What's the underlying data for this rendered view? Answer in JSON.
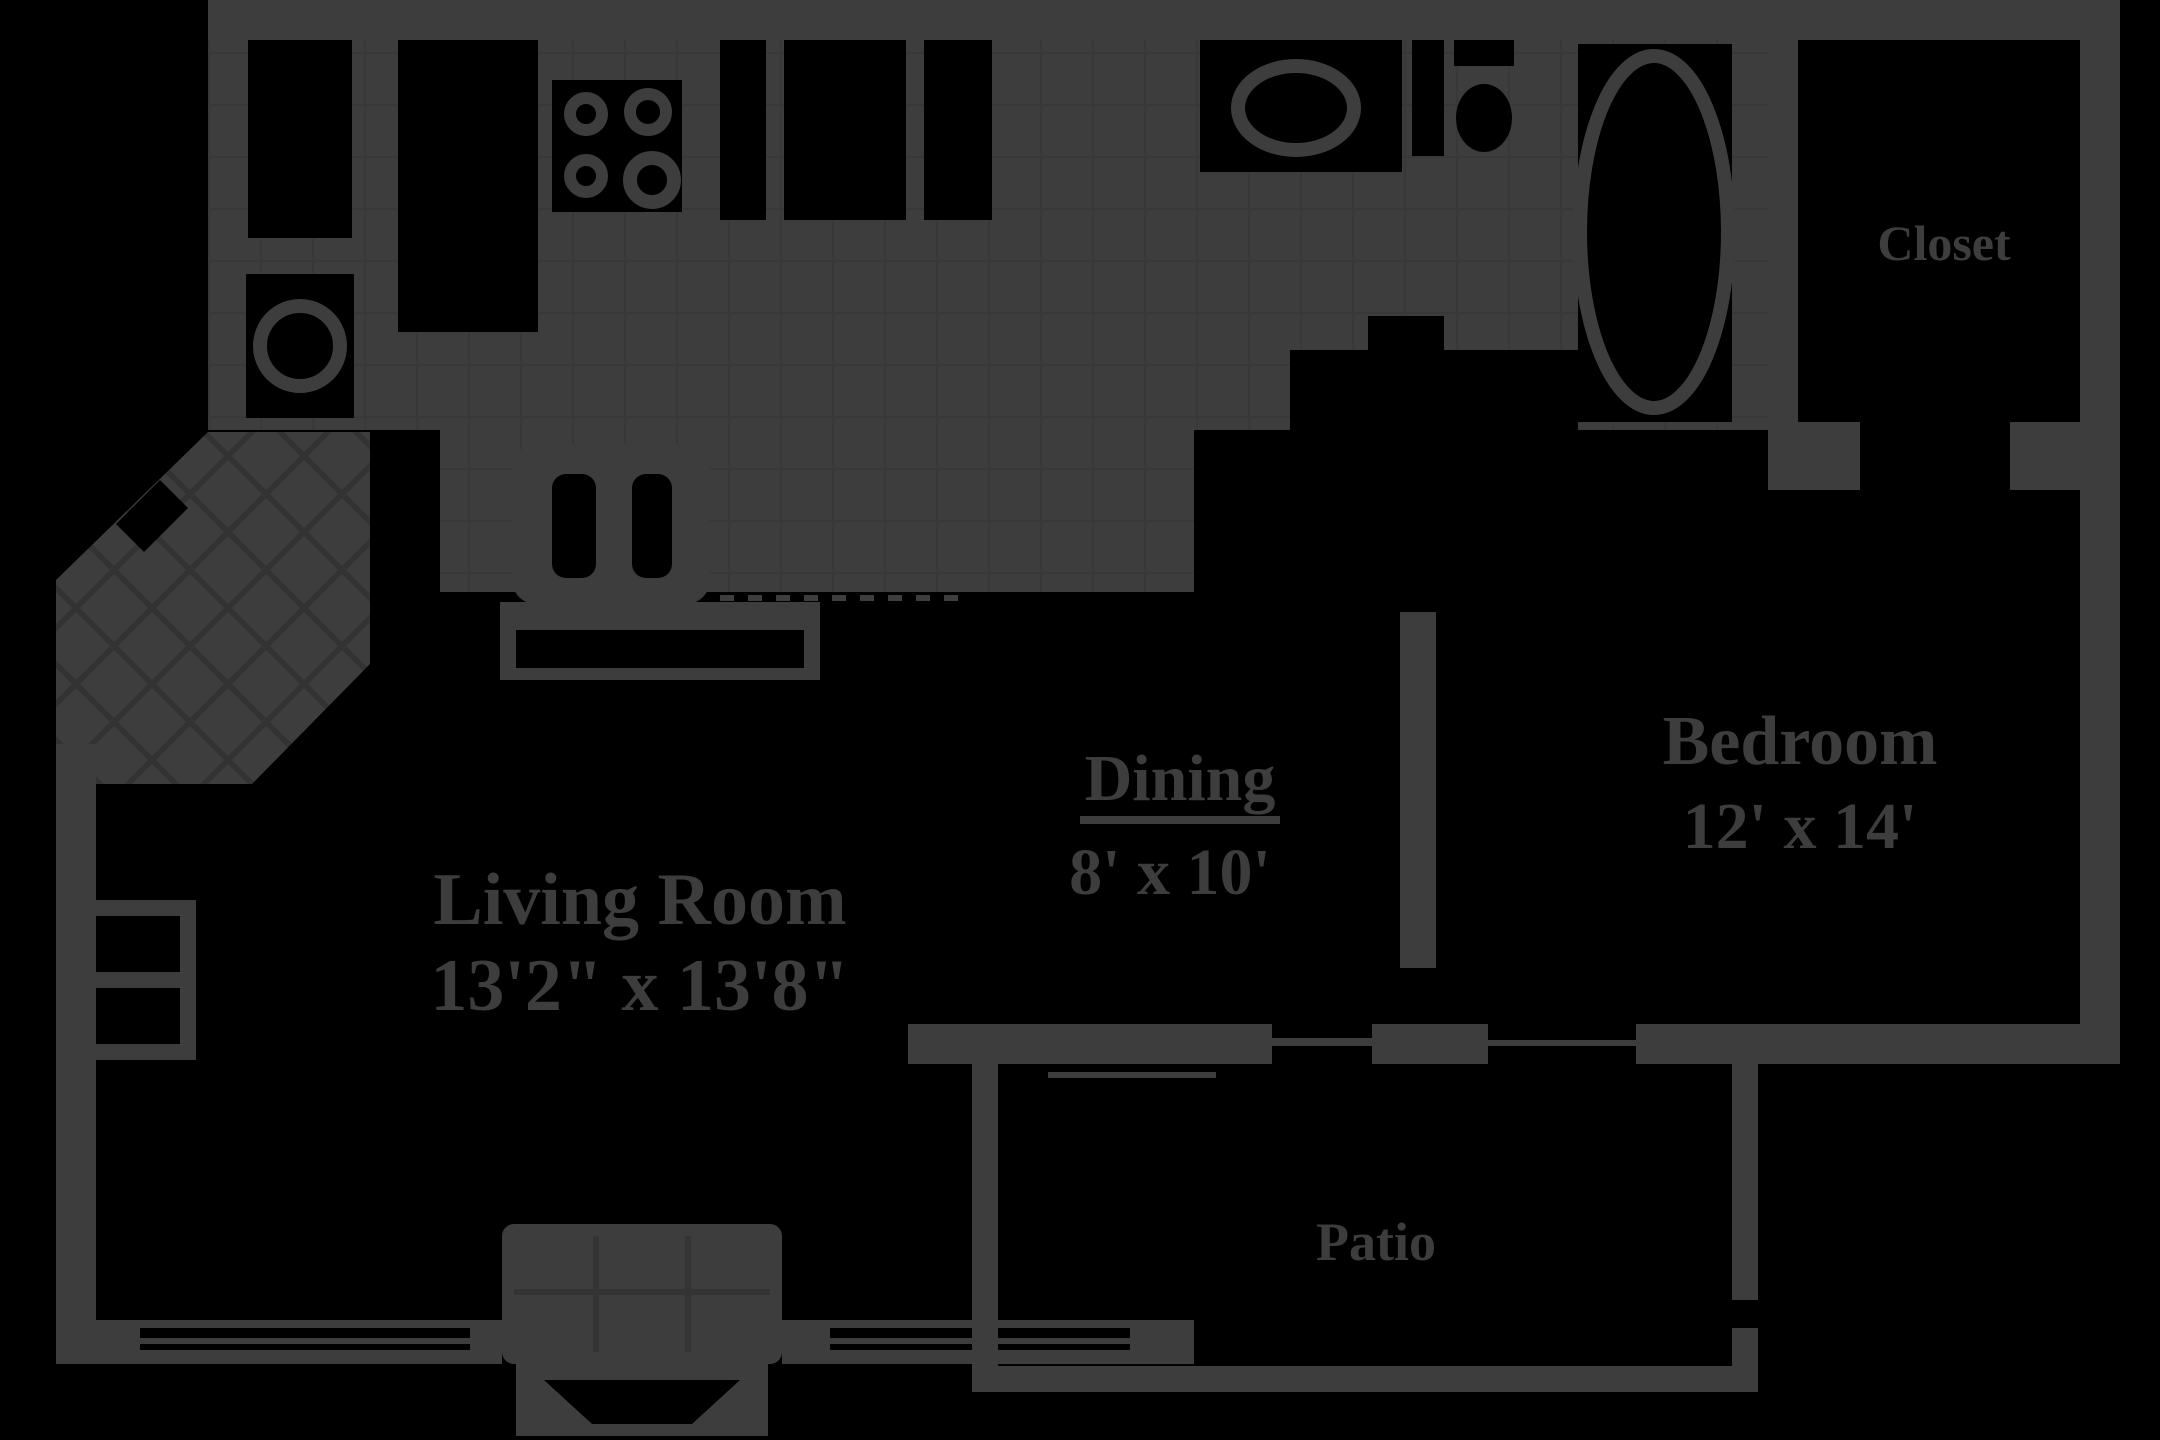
{
  "document_type": "apartment-floor-plan",
  "colors": {
    "background": "#000000",
    "walls_and_fixtures": "#3d3d3d",
    "tile_lines": "#343434"
  },
  "rooms": {
    "living": {
      "name": "Living Room",
      "dims": "13'2\" x 13'8\""
    },
    "dining": {
      "name": "Dining",
      "dims": "8' x 10'"
    },
    "bedroom": {
      "name": "Bedroom",
      "dims": "12' x 14'"
    },
    "closet": {
      "name": "Closet"
    },
    "patio": {
      "name": "Patio"
    }
  },
  "fixtures": [
    "washer-dryer-circle",
    "utility-closet-doors",
    "stove-four-burners",
    "kitchen-counter-openings",
    "breakfast-bar-double-sink",
    "bar-pass-through-slot",
    "bathroom-vanity-oval-sink",
    "toilet",
    "bathtub-oval",
    "entry-tile-lattice",
    "fireplace-with-hearth",
    "living-room-windows",
    "patio-sliding-door",
    "bedroom-window",
    "patio-railing"
  ]
}
